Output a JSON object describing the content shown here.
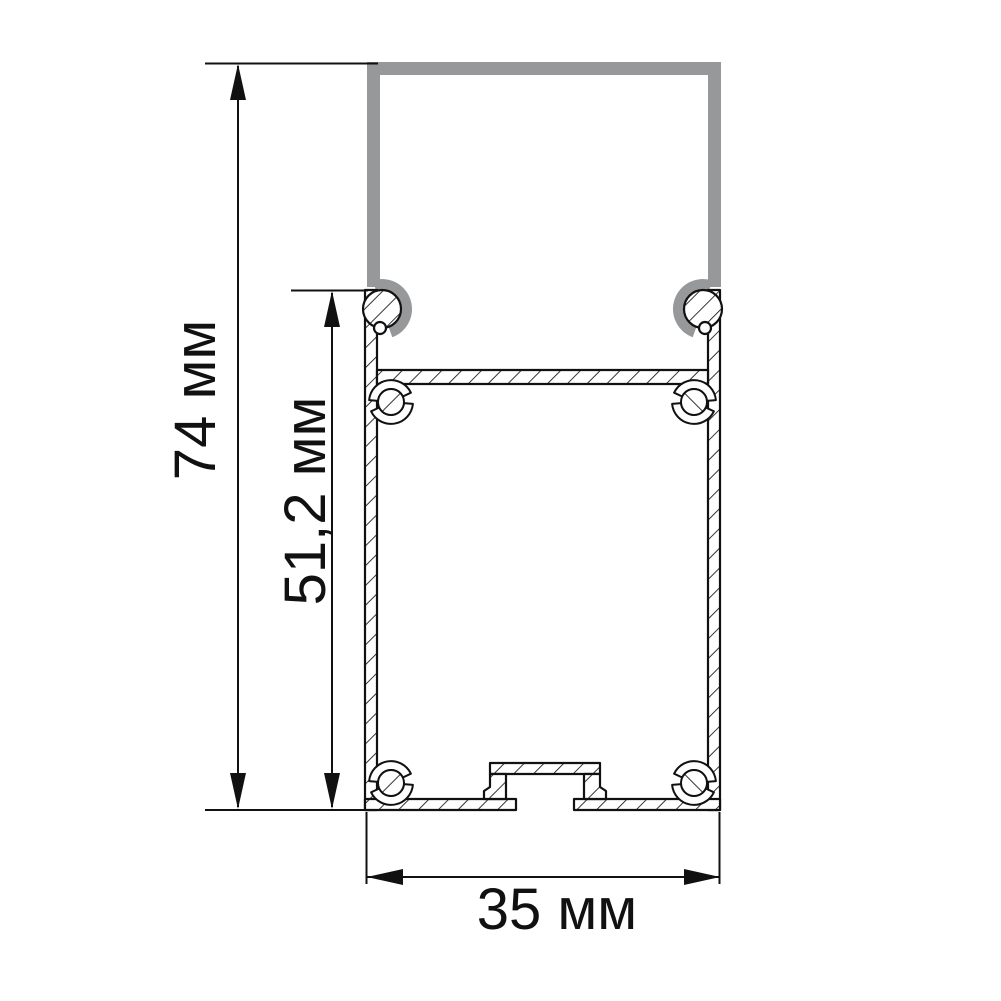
{
  "drawing": {
    "kind": "technical-cross-section",
    "subject": "aluminum LED profile with clip-on cover",
    "background": "#ffffff",
    "colors": {
      "line": "#111111",
      "cover_gray": "#97989a",
      "fill": "#ffffff"
    },
    "dimensions": {
      "overall_height": {
        "label": "74 мм",
        "value": "74",
        "unit": "мм",
        "orientation": "vertical"
      },
      "body_height": {
        "label": "51,2 мм",
        "value": "51,2",
        "unit": "мм",
        "orientation": "vertical"
      },
      "overall_width": {
        "label": "35 мм",
        "value": "35",
        "unit": "мм",
        "orientation": "horizontal"
      }
    }
  }
}
